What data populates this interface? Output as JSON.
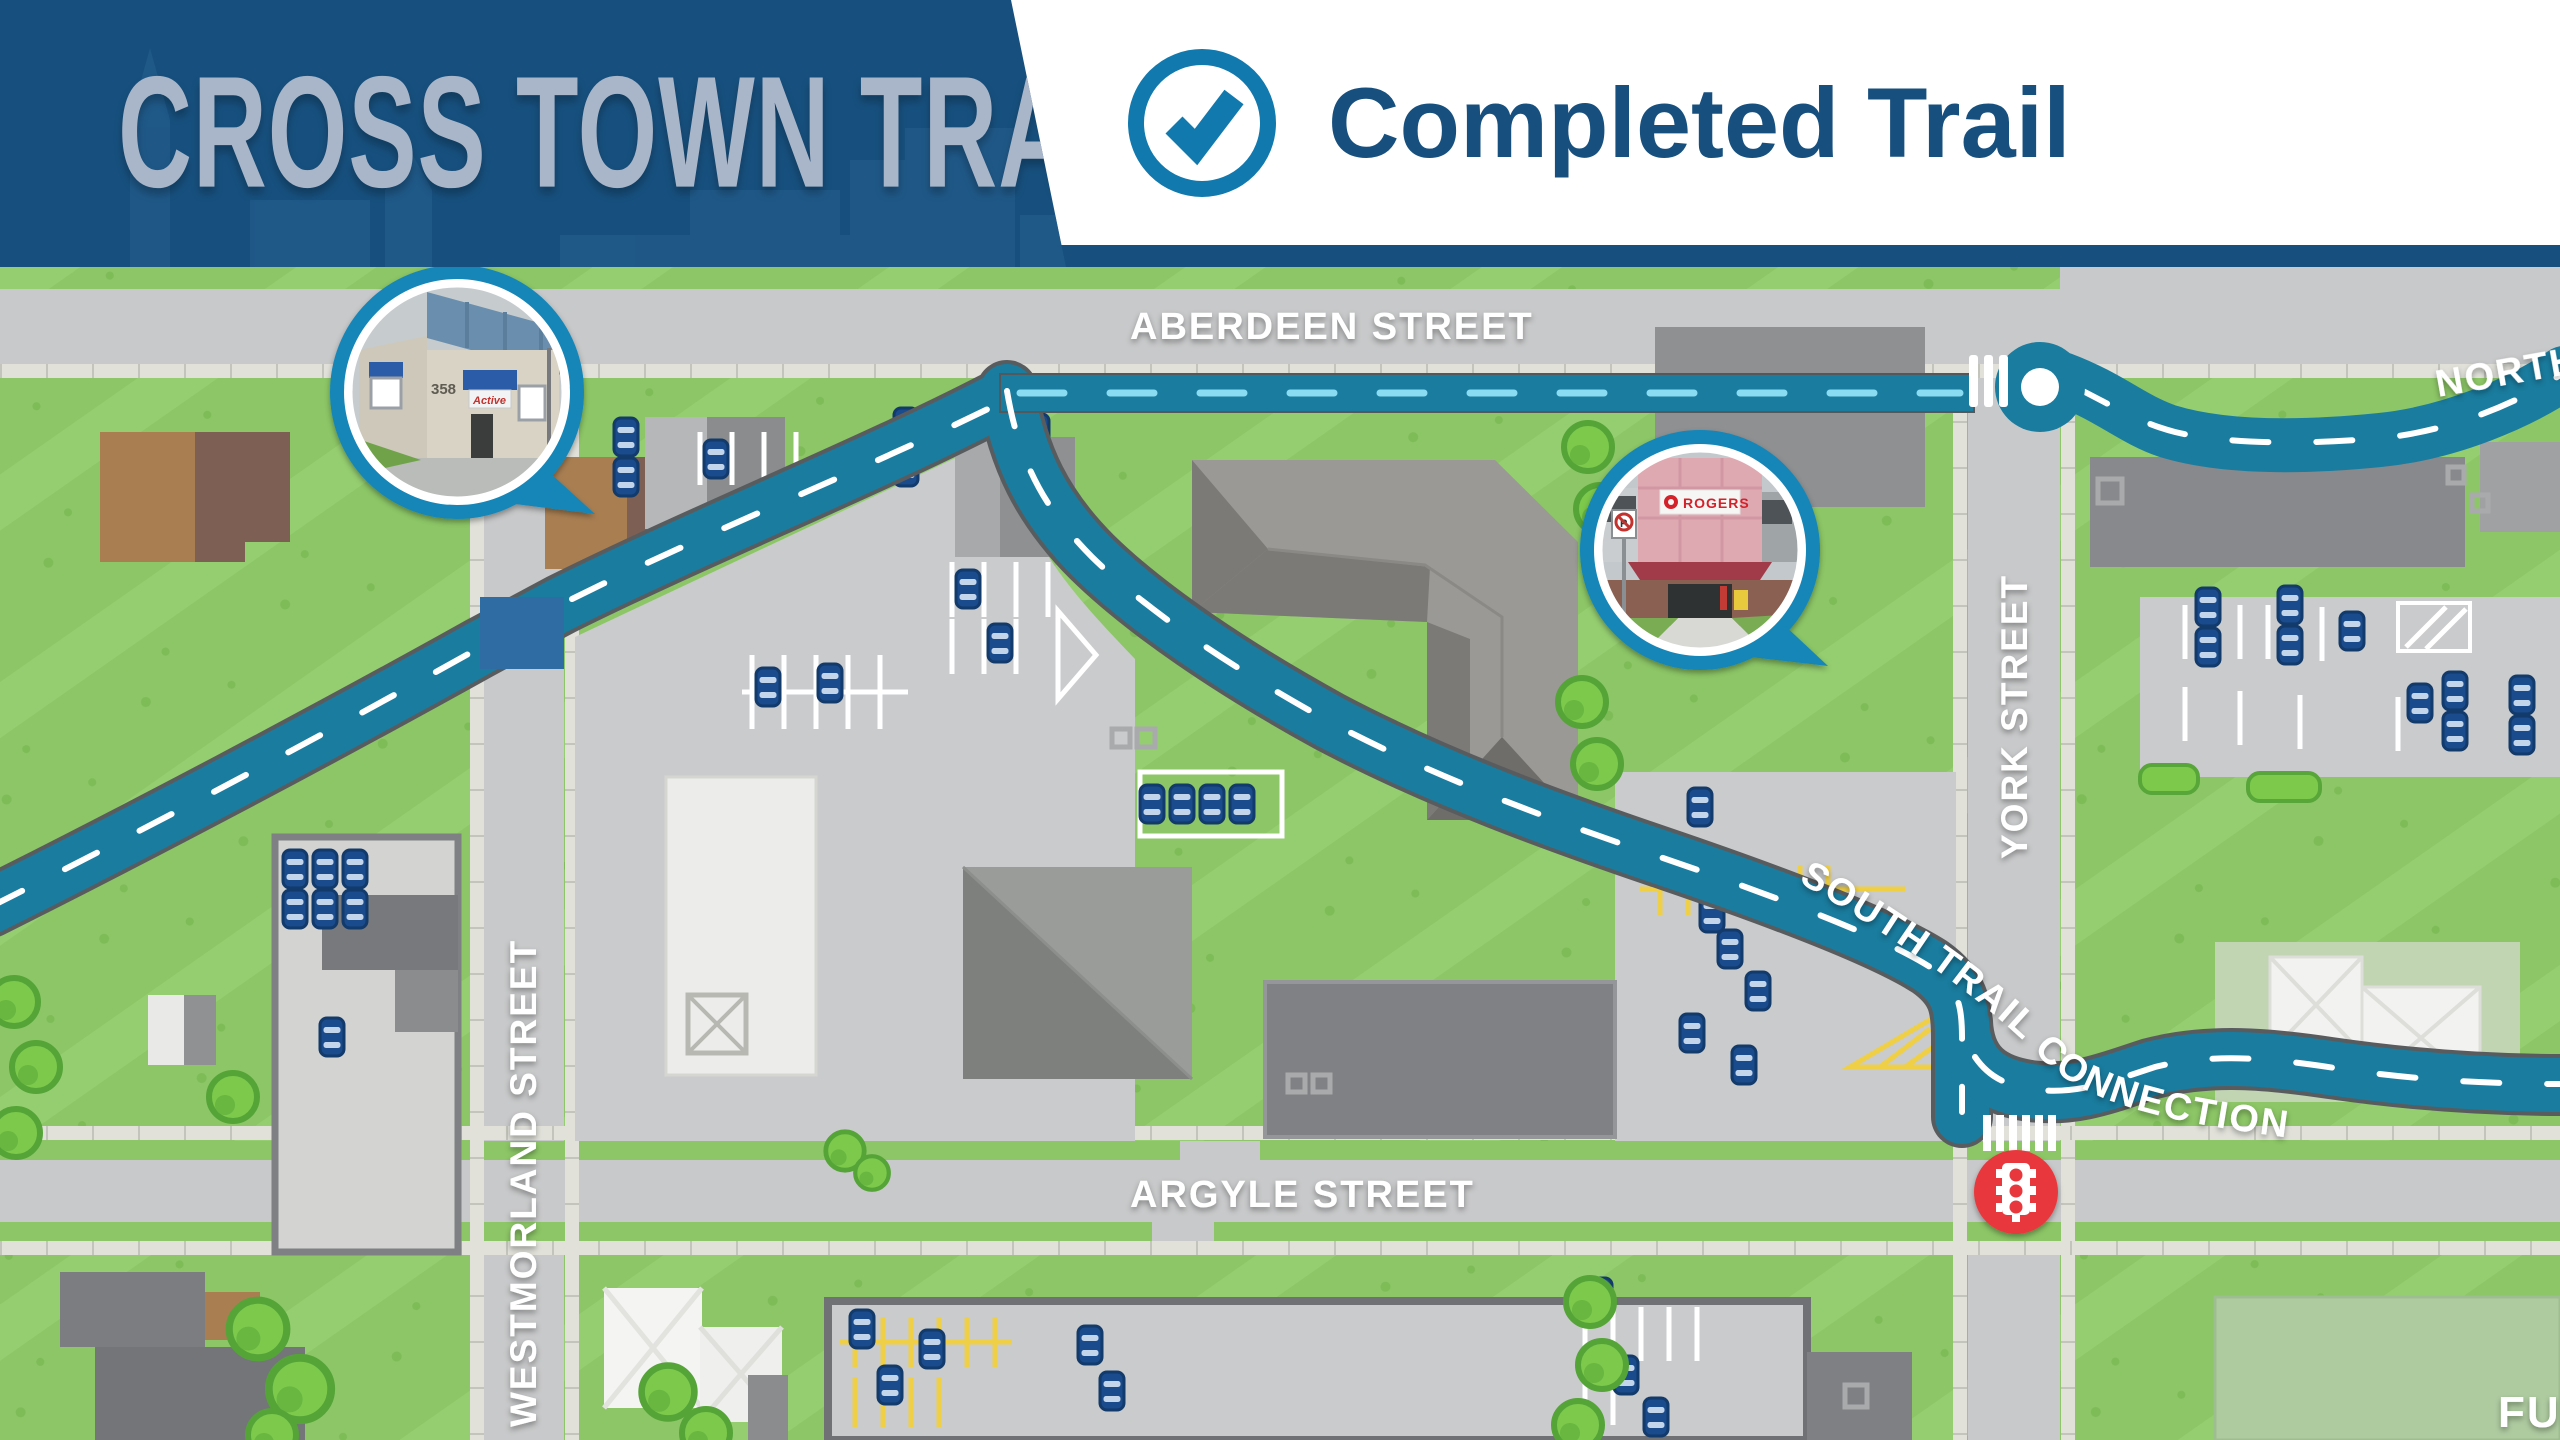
{
  "header": {
    "title": "CROSS TOWN TRAIL",
    "legend": {
      "icon": "check-circle-icon",
      "label": "Completed Trail"
    }
  },
  "map": {
    "streets": {
      "aberdeen": "ABERDEEN STREET",
      "westmorland": "WESTMORLAND STREET",
      "york": "YORK STREET",
      "argyle": "ARGYLE STREET"
    },
    "trail": {
      "south_connection_label": "SOUTH TRAIL CONNECTION",
      "north_label_partial": "NORTH T",
      "future_label_partial": "FU"
    },
    "insets": {
      "active_building": {
        "street_number": "358",
        "awning_text": "Active"
      },
      "rogers_building": {
        "sign_text": "ROGERS",
        "logo": "rogers-logo-icon",
        "no_parking": "no-parking-sign-icon"
      }
    },
    "icons": {
      "traffic_light": "traffic-light-icon",
      "roundabout": "trail-roundabout-marker",
      "crosswalk": "crosswalk-bars",
      "trail_crossing": "road-crossing-marker"
    },
    "colors": {
      "header_navy": "#17507E",
      "check_blue": "#1179AE",
      "trail_teal": "#1A7C9E",
      "trail_dash_aberdeen": "#8ADCF3",
      "trail_dash": "#FFFFFF",
      "road_crossing_blue": "#2F6CA4",
      "grass_green": "#8CC666",
      "road_gray": "#C8C9CA",
      "car_navy": "#1A4B8C",
      "traffic_light_red": "#E8393D",
      "parking_yellow": "#EFCF45"
    }
  }
}
